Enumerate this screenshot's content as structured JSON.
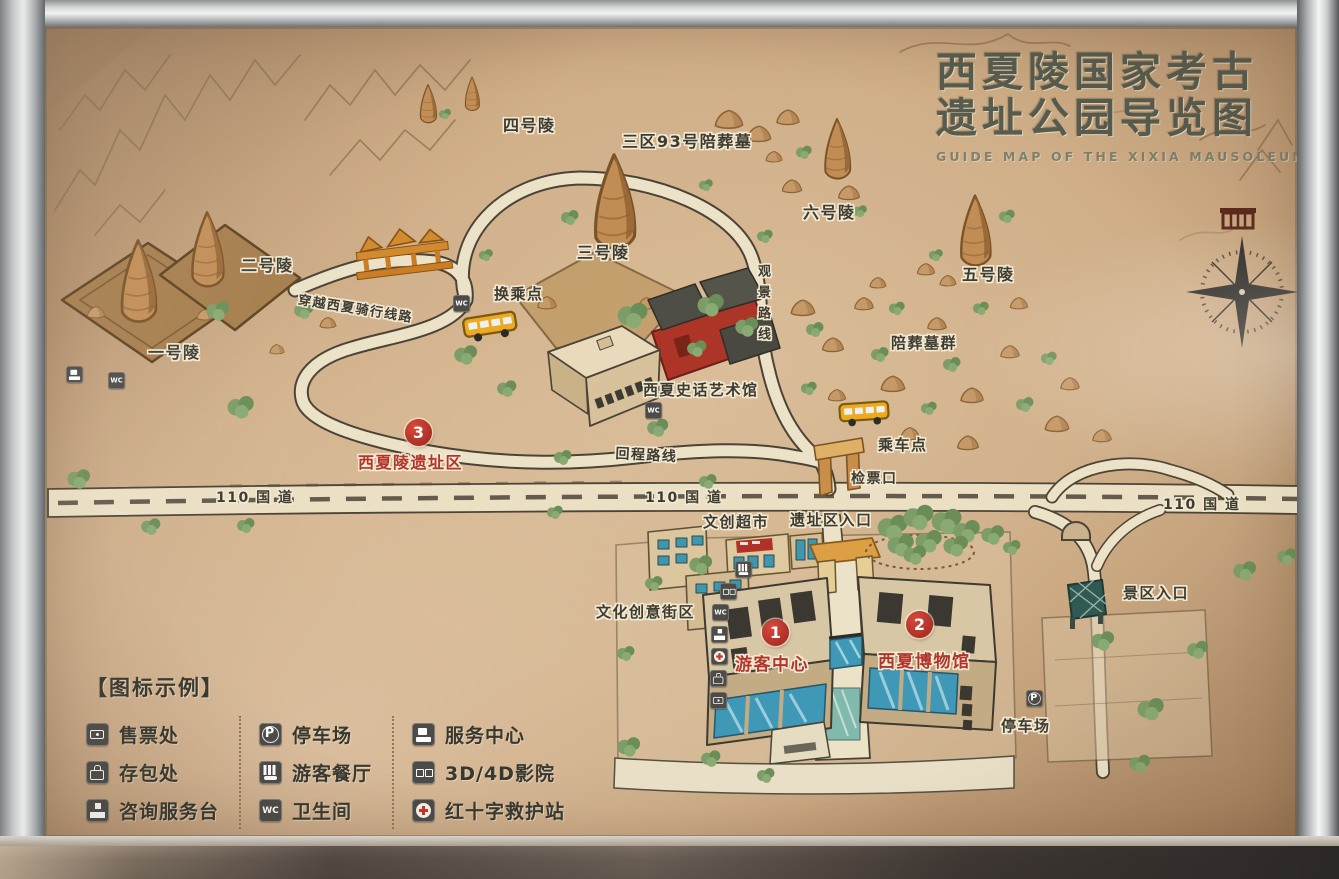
{
  "title": {
    "line1": "西夏陵国家考古",
    "line2": "遗址公园导览图",
    "subtitle": "GUIDE MAP OF THE XIXIA MAUSOLEUM"
  },
  "colors": {
    "accent_red": "#b2352b",
    "sand": "#cfae87",
    "road_cream": "#ece2c8",
    "vegetation_green": "#7d9d68",
    "title_gray_green": "#575c4e"
  },
  "map": {
    "labels": [
      {
        "id": "tomb-4",
        "text": "四号陵",
        "x": 503,
        "y": 112,
        "fs": 16,
        "color": "dark"
      },
      {
        "id": "tomb-93",
        "text": "三区93号陪葬墓",
        "x": 622,
        "y": 128,
        "fs": 16,
        "color": "dark"
      },
      {
        "id": "tomb-6",
        "text": "六号陵",
        "x": 803,
        "y": 199,
        "fs": 16,
        "color": "dark"
      },
      {
        "id": "tomb-5",
        "text": "五号陵",
        "x": 962,
        "y": 261,
        "fs": 16,
        "color": "dark"
      },
      {
        "id": "tomb-3",
        "text": "三号陵",
        "x": 577,
        "y": 239,
        "fs": 16,
        "color": "dark"
      },
      {
        "id": "tomb-2",
        "text": "二号陵",
        "x": 241,
        "y": 252,
        "fs": 16,
        "color": "dark"
      },
      {
        "id": "tomb-1",
        "text": "一号陵",
        "x": 148,
        "y": 339,
        "fs": 16,
        "color": "dark"
      },
      {
        "id": "transfer-point",
        "text": "换乘点",
        "x": 494,
        "y": 283,
        "fs": 15,
        "color": "dark"
      },
      {
        "id": "cycling-route",
        "text": "穿越西夏骑行线路",
        "x": 300,
        "y": 289,
        "fs": 13,
        "color": "dark",
        "rot": 9
      },
      {
        "id": "art-museum",
        "text": "西夏史话艺术馆",
        "x": 643,
        "y": 379,
        "fs": 15,
        "color": "dark"
      },
      {
        "id": "return-route",
        "text": "回程路线",
        "x": 616,
        "y": 443,
        "fs": 14,
        "color": "dark",
        "rot": 3
      },
      {
        "id": "scenic-route",
        "text": "观景路线",
        "x": 753,
        "y": 264,
        "fs": 13,
        "color": "dark",
        "vertical": true
      },
      {
        "id": "tomb-cluster",
        "text": "陪葬墓群",
        "x": 891,
        "y": 332,
        "fs": 15,
        "color": "dark"
      },
      {
        "id": "boarding-point",
        "text": "乘车点",
        "x": 878,
        "y": 434,
        "fs": 15,
        "color": "dark"
      },
      {
        "id": "ticket-gate",
        "text": "检票口",
        "x": 851,
        "y": 468,
        "fs": 14,
        "color": "dark"
      },
      {
        "id": "highway-110-left",
        "text": "110 国 道",
        "x": 216,
        "y": 487,
        "fs": 14,
        "color": "dark"
      },
      {
        "id": "highway-110-center",
        "text": "110 国 道",
        "x": 645,
        "y": 487,
        "fs": 14,
        "color": "dark"
      },
      {
        "id": "highway-110-right",
        "text": "110 国 道",
        "x": 1163,
        "y": 494,
        "fs": 14,
        "color": "dark"
      },
      {
        "id": "cultural-market",
        "text": "文创超市",
        "x": 703,
        "y": 511,
        "fs": 15,
        "color": "dark"
      },
      {
        "id": "site-entrance",
        "text": "遗址区入口",
        "x": 790,
        "y": 509,
        "fs": 15,
        "color": "dark"
      },
      {
        "id": "creative-block",
        "text": "文化创意街区",
        "x": 596,
        "y": 601,
        "fs": 15,
        "color": "dark"
      },
      {
        "id": "scenic-entrance",
        "text": "景区入口",
        "x": 1123,
        "y": 582,
        "fs": 15,
        "color": "dark"
      },
      {
        "id": "visitor-center",
        "text": "游客中心",
        "x": 735,
        "y": 650,
        "fs": 17,
        "color": "red"
      },
      {
        "id": "xixia-museum",
        "text": "西夏博物馆",
        "x": 878,
        "y": 647,
        "fs": 17,
        "color": "red"
      },
      {
        "id": "site-area",
        "text": "西夏陵遗址区",
        "x": 358,
        "y": 449,
        "fs": 16,
        "color": "red"
      },
      {
        "id": "parking-lot",
        "text": "停车场",
        "x": 1001,
        "y": 715,
        "fs": 15,
        "color": "dark"
      }
    ],
    "markers": [
      {
        "num": "1",
        "x": 762,
        "y": 619
      },
      {
        "num": "2",
        "x": 906,
        "y": 611
      },
      {
        "num": "3",
        "x": 405,
        "y": 419
      }
    ],
    "icons": [
      {
        "name": "toilet",
        "x": 453,
        "y": 295
      },
      {
        "name": "toilet",
        "x": 645,
        "y": 402
      },
      {
        "name": "service-center",
        "x": 66,
        "y": 366
      },
      {
        "name": "toilet",
        "x": 108,
        "y": 372
      },
      {
        "name": "restaurant",
        "x": 735,
        "y": 561
      },
      {
        "name": "cinema",
        "x": 720,
        "y": 583
      },
      {
        "name": "toilet",
        "x": 712,
        "y": 604
      },
      {
        "name": "information-desk",
        "x": 711,
        "y": 626
      },
      {
        "name": "first-aid",
        "x": 711,
        "y": 648
      },
      {
        "name": "luggage-storage",
        "x": 710,
        "y": 670
      },
      {
        "name": "ticket-office",
        "x": 710,
        "y": 692
      },
      {
        "name": "parking",
        "x": 1026,
        "y": 690
      }
    ]
  },
  "legend": {
    "header": "【图标示例】",
    "columns": [
      {
        "items": [
          {
            "icon": "ticket-office",
            "label": "售票处"
          },
          {
            "icon": "luggage-storage",
            "label": "存包处"
          },
          {
            "icon": "information-desk",
            "label": "咨询服务台"
          }
        ]
      },
      {
        "items": [
          {
            "icon": "parking",
            "label": "停车场"
          },
          {
            "icon": "restaurant",
            "label": "游客餐厅"
          },
          {
            "icon": "toilet",
            "label": "卫生间"
          }
        ]
      },
      {
        "items": [
          {
            "icon": "service-center",
            "label": "服务中心"
          },
          {
            "icon": "cinema",
            "label": "3D/4D影院"
          },
          {
            "icon": "first-aid",
            "label": "红十字救护站"
          }
        ]
      }
    ]
  }
}
